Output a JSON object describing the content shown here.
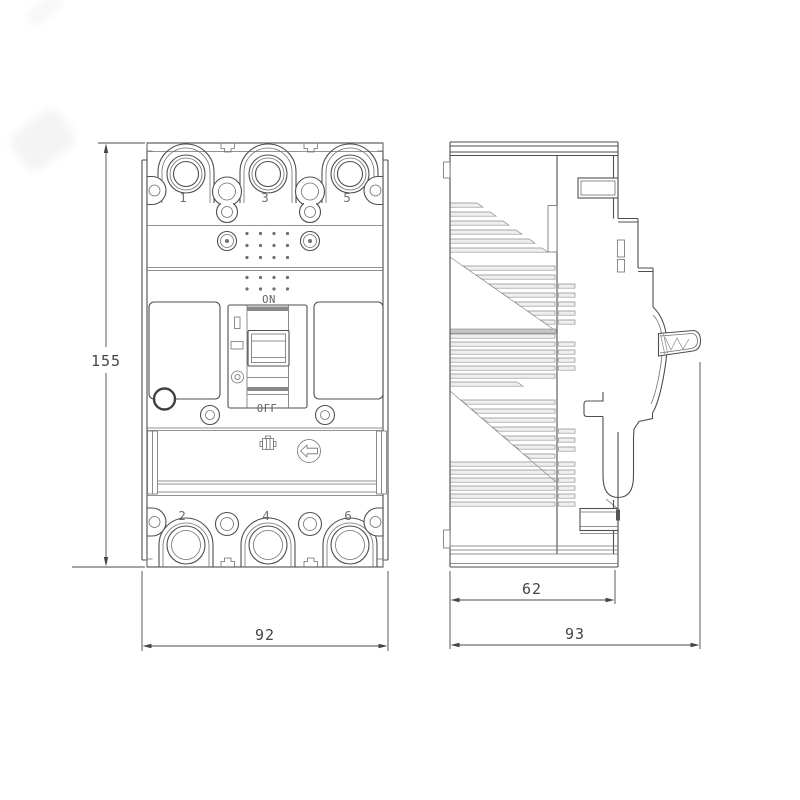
{
  "drawing": {
    "subject": "molded-case circuit breaker technical drawing, front and side orthographic views",
    "front_view": {
      "terminals_top": [
        "1",
        "3",
        "5"
      ],
      "terminals_bottom": [
        "2",
        "4",
        "6"
      ],
      "switch": {
        "on": "ON",
        "off": "OFF"
      }
    },
    "dimensions": {
      "height": "155",
      "width": "92",
      "depth_body": "62",
      "depth_overall": "93"
    },
    "colors": {
      "background": "#ffffff",
      "outline": "#4f4f4f",
      "secondary_line": "#6f6f6f",
      "rib_line": "#8f8f8f",
      "dimension": "#454545",
      "label_text": "#5f5f5f"
    }
  }
}
